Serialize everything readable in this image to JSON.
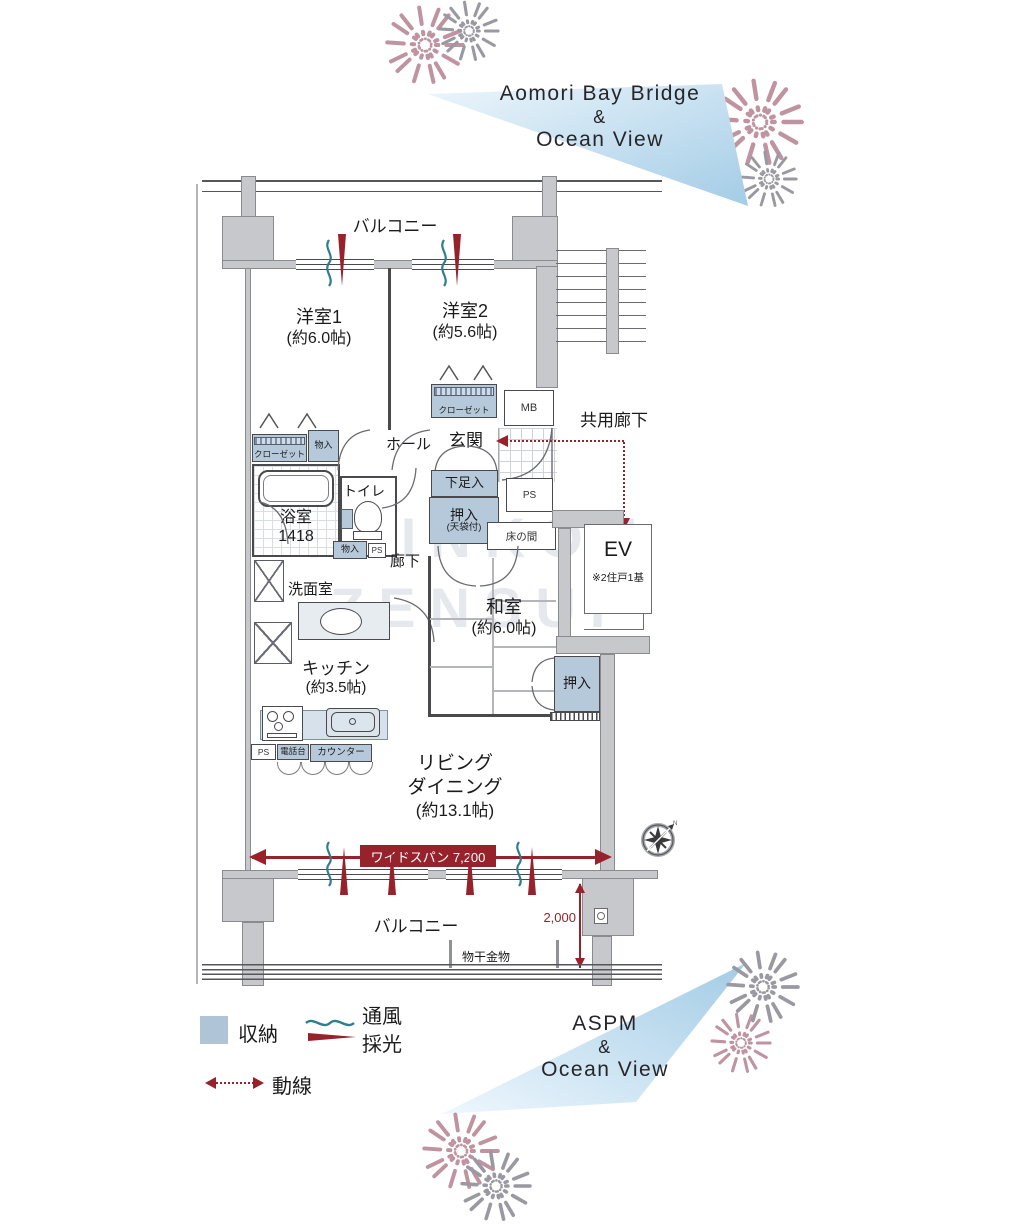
{
  "views": {
    "top": {
      "line1": "Aomori Bay Bridge",
      "line2": "&",
      "line3": "Ocean View"
    },
    "bottom": {
      "line1": "ASPM",
      "line2": "&",
      "line3": "Ocean View"
    }
  },
  "watermark": {
    "line1": "SHINKOU",
    "line2": "ZENSUI"
  },
  "plan": {
    "balcony_top": "バルコニー",
    "balcony_bottom": "バルコニー",
    "rooms": {
      "western1": {
        "name": "洋室1",
        "size": "(約6.0帖)"
      },
      "western2": {
        "name": "洋室2",
        "size": "(約5.6帖)"
      },
      "japanese": {
        "name": "和室",
        "size": "(約6.0帖)"
      },
      "kitchen": {
        "name": "キッチン",
        "size": "(約3.5帖)"
      },
      "living": {
        "name1": "リビング",
        "name2": "ダイニング",
        "size": "(約13.1帖)"
      },
      "bath": {
        "name": "浴室",
        "size": "1418"
      },
      "washroom": "洗面室",
      "toilet": "トイレ",
      "hall": "ホール",
      "corridor": "廊下",
      "entrance": "玄関"
    },
    "storage": {
      "closet_w2": "クローゼット",
      "closet_w1": "クローゼット",
      "monoire_w1": "物入",
      "monoire_hall": "物入",
      "shoe_box": "下足入",
      "oshiire_hall1": "押入",
      "oshiire_hall2": "(天袋付)",
      "oshiire_washitsu": "押入",
      "tokonoma": "床の間"
    },
    "small": {
      "mb": "MB",
      "ps_entrance": "PS",
      "ps_corridor": "PS",
      "ps_kitchen": "PS",
      "phone": "電話台",
      "counter": "カウンター"
    },
    "common": {
      "corridor": "共用廊下",
      "ev": "EV",
      "ev_note": "※2住戸1基"
    },
    "dims": {
      "widespan": "ワイドスパン 7,200",
      "height": "2,000",
      "monohoshi": "物干金物"
    }
  },
  "legend": {
    "storage": "収納",
    "vent": "通風",
    "light": "採光",
    "flow": "動線"
  },
  "colors": {
    "storage_fill": "#b6c9db",
    "accent_red": "#96222c",
    "vent_teal": "#2f7e8e",
    "wall_gray": "#c6c8cb",
    "view_blue": "#aed3ea",
    "firework_pink": "#bf93a0",
    "firework_gray": "#9a99a1"
  }
}
